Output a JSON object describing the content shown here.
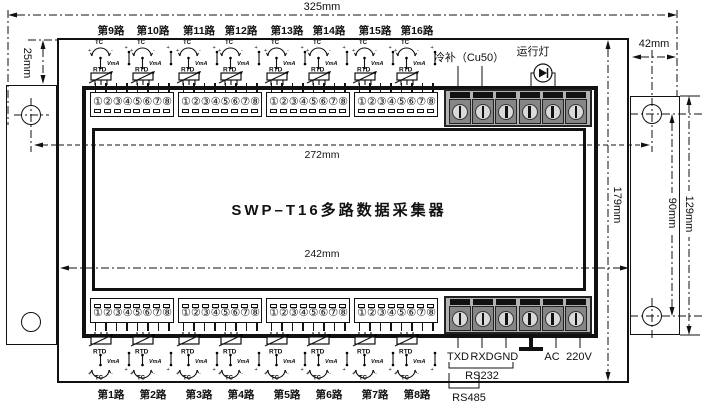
{
  "device": {
    "title": "SWP–T16多路数据采集器"
  },
  "dims": {
    "overall_width": "325mm",
    "flange_width": "42mm",
    "top_inset": "25mm",
    "hole_span": "272mm",
    "body_width": "242mm",
    "body_height": "179mm",
    "hole_vspan": "90mm",
    "flange_height": "129mm"
  },
  "channels": {
    "top": [
      "第9路",
      "第10路",
      "第11路",
      "第12路",
      "第13路",
      "第14路",
      "第15路",
      "第16路"
    ],
    "bottom": [
      "第1路",
      "第2路",
      "第3路",
      "第4路",
      "第5路",
      "第6路",
      "第7路",
      "第8路"
    ]
  },
  "terminals": {
    "numbers": [
      "①",
      "②",
      "③",
      "④",
      "⑤",
      "⑥",
      "⑦",
      "⑧"
    ]
  },
  "sensor": {
    "tc": "TC",
    "rtd": "RTD",
    "vma": "VmA",
    "plus": "+",
    "minus": "-"
  },
  "aux": {
    "cold_junction": "冷补（Cu50）",
    "run_light": "运行灯"
  },
  "comm": {
    "txd": "TXD",
    "rxd": "RXD",
    "gnd": "GND",
    "rs232": "RS232",
    "rs485": "RS485"
  },
  "power": {
    "ac": "AC",
    "voltage": "220V"
  }
}
